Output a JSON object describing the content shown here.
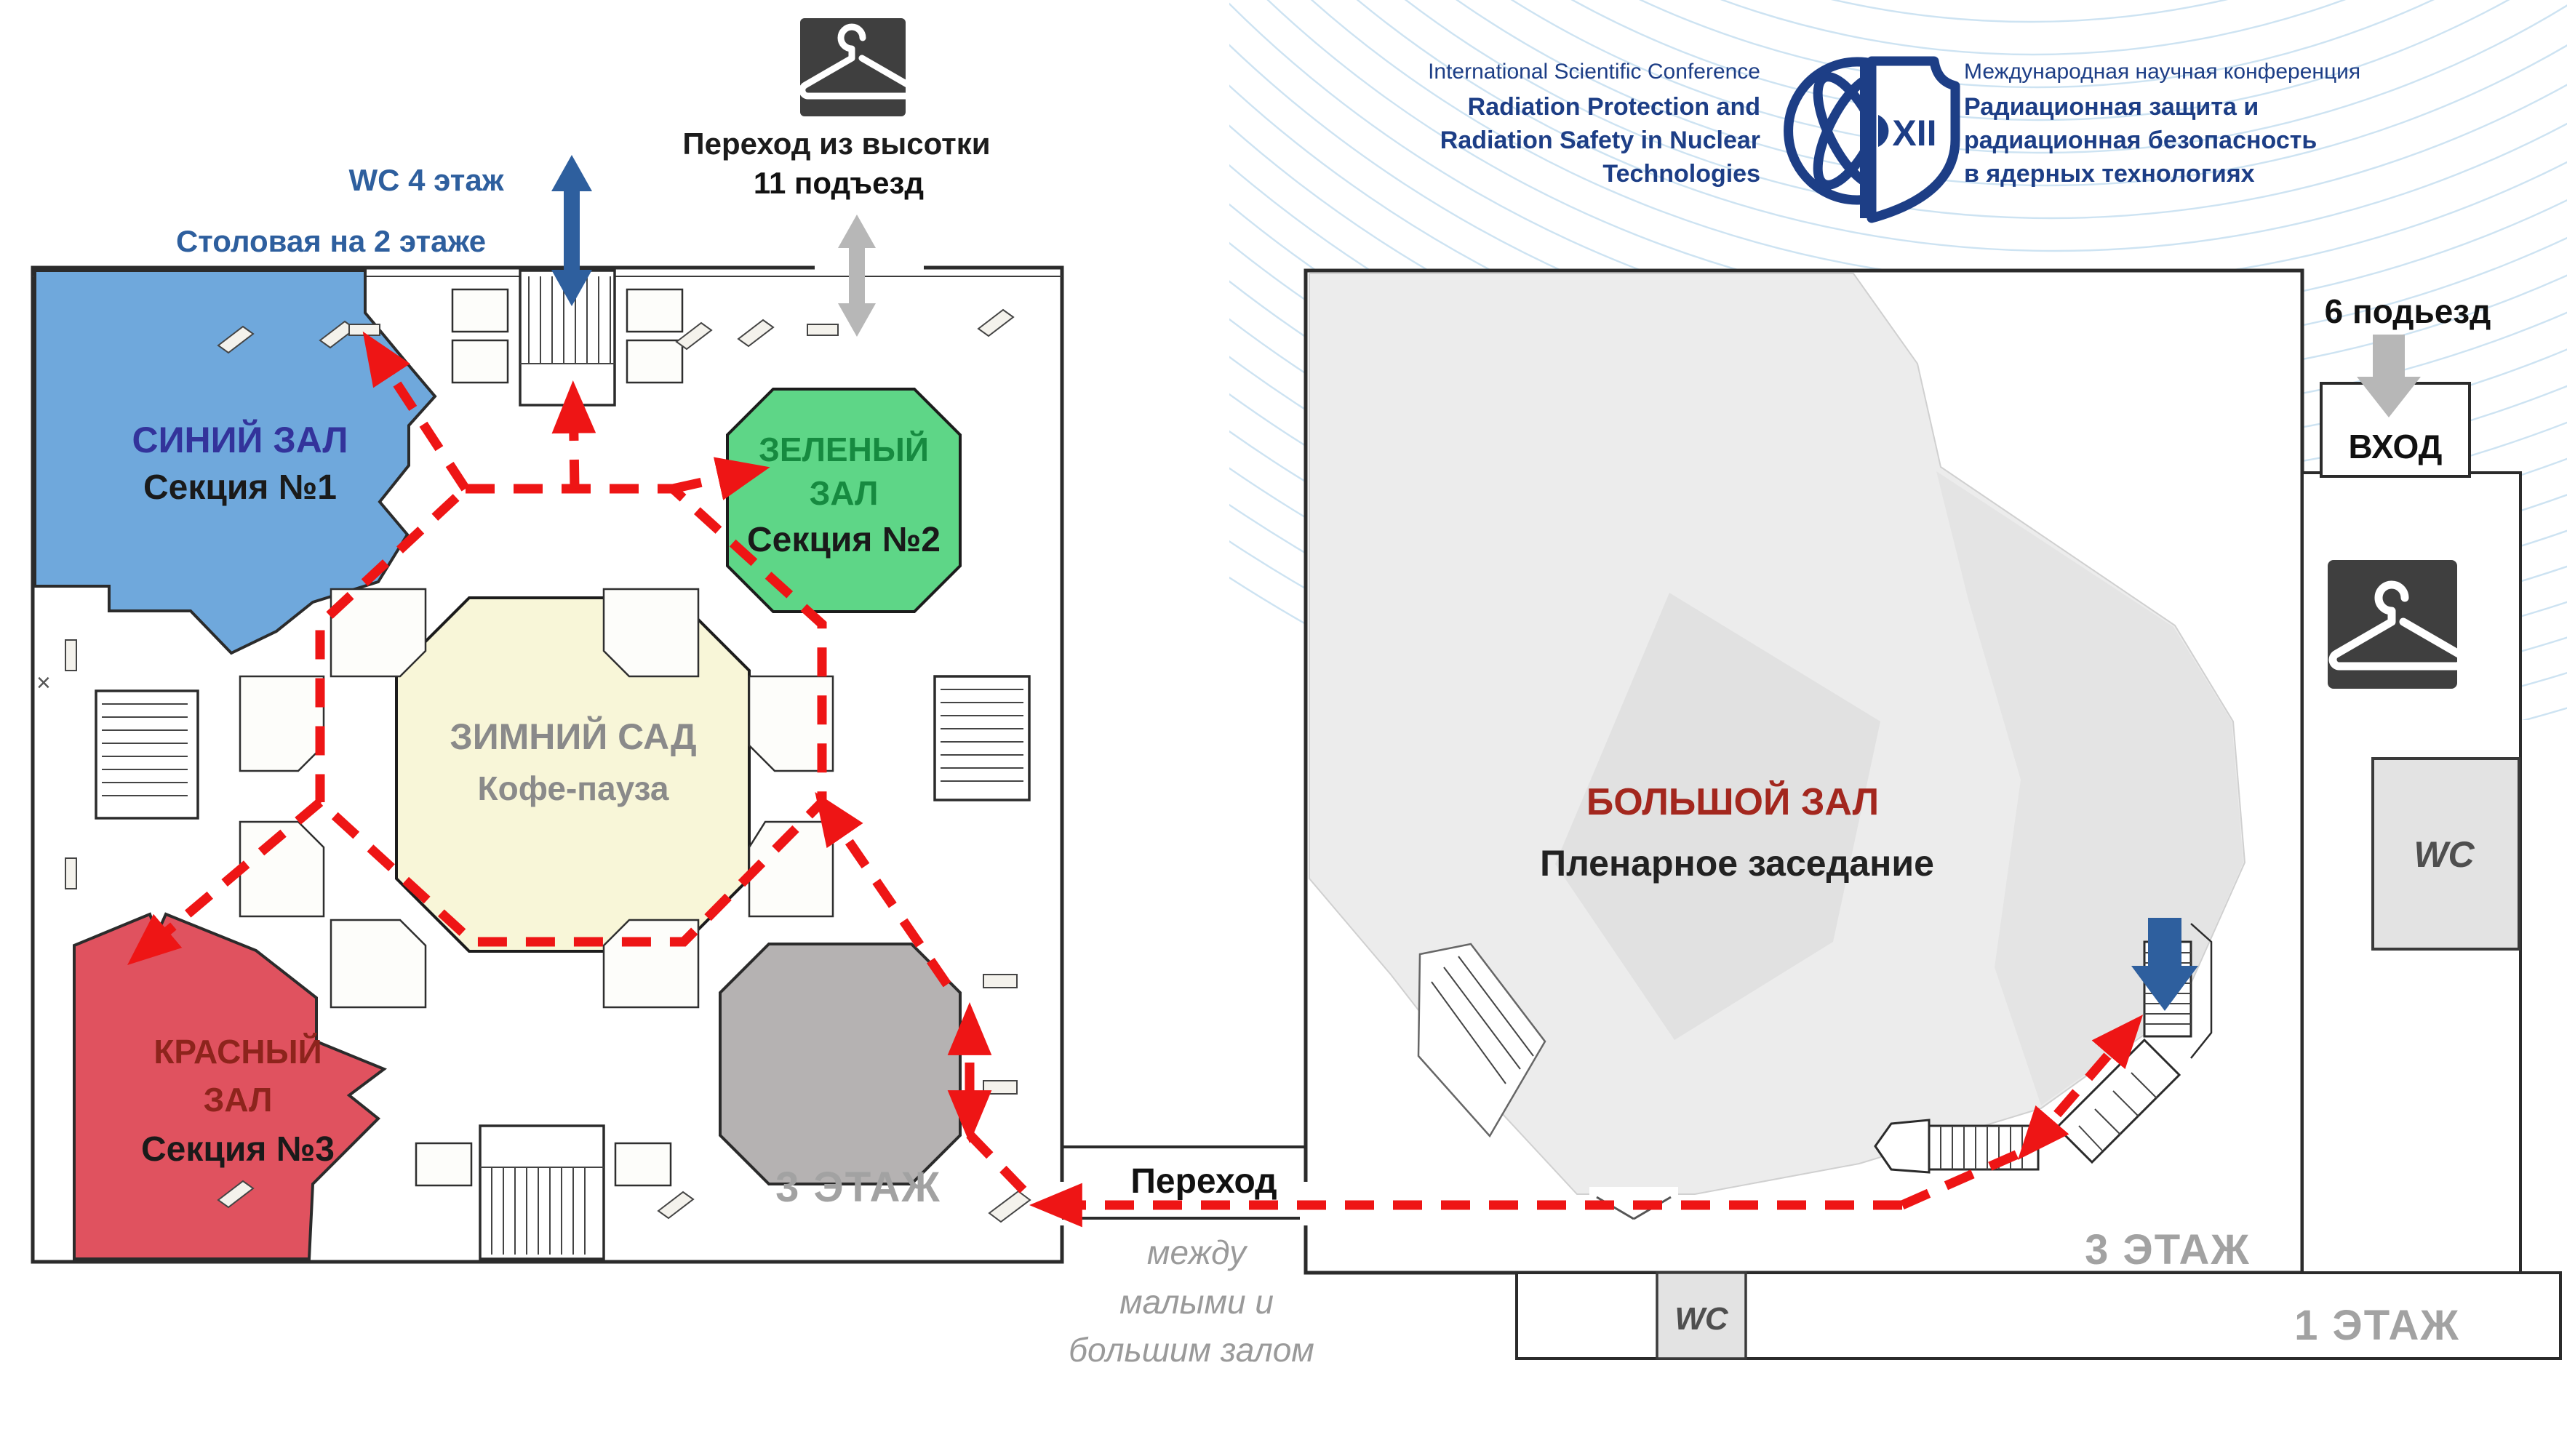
{
  "header": {
    "en": [
      "International Scientific Conference",
      "Radiation Protection and",
      "Radiation Safety in Nuclear",
      "Technologies"
    ],
    "ru": [
      "Международная научная конференция",
      "Радиационная защита и",
      "радиационная безопасность",
      "в ядерных технологиях"
    ],
    "logo": {
      "numeral": "XII"
    }
  },
  "left_plan": {
    "floor_label": "3 ЭТАЖ",
    "edge_mark": "×",
    "top": {
      "wc": "WC 4 этаж",
      "canteen": "Столовая на 2 этаже",
      "highrise1": "Переход из высотки",
      "highrise2": "11 подъезд"
    },
    "halls": {
      "blue": {
        "title": "СИНИЙ ЗАЛ",
        "section": "Секция №1"
      },
      "green": {
        "title1": "ЗЕЛЕНЫЙ",
        "title2": "ЗАЛ",
        "section": "Секция №2"
      },
      "winter": {
        "title": "ЗИМНИЙ САД",
        "subtitle": "Кофе-пауза"
      },
      "red": {
        "title1": "КРАСНЫЙ",
        "title2": "ЗАЛ",
        "section": "Секция №3"
      }
    }
  },
  "corridor": {
    "title": "Переход",
    "subtitle": [
      "между",
      "малыми и",
      "большим залом"
    ]
  },
  "right_plan": {
    "hall_title": "БОЛЬШОЙ ЗАЛ",
    "hall_subtitle": "Пленарное заседание",
    "entrance_label": "6 подьезд",
    "entrance_box": "ВХОД",
    "wc_side": "WC",
    "wc_bottom": "WC",
    "floor3_label": "3 ЭТАЖ",
    "floor1_label": "1 ЭТАЖ"
  },
  "colors": {
    "accent_navy": "#1d3e86",
    "route_red": "#ee1515",
    "blue_hall": "#6fa8dc",
    "green_hall": "#5ed687",
    "red_hall": "#e0525f",
    "winter_hall": "#f8f6d8",
    "gray_octagon": "#b5b2b2",
    "big_hall_gray": "#ececec",
    "stair_arrow_blue": "#2e5f9e",
    "arrow_gray": "#b7b7b7",
    "floor_label_gray": "#a2a2a2",
    "wave_blue": "#bcd9ee"
  }
}
